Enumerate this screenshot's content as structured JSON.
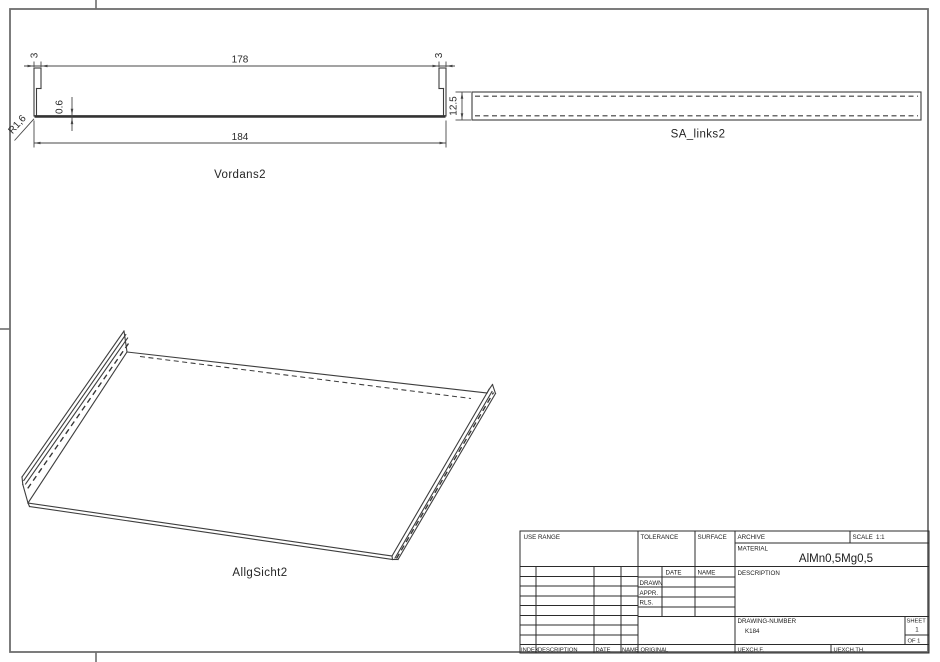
{
  "drawing": {
    "views": {
      "front": {
        "label": "Vordans2",
        "dim_flange_left": "3",
        "dim_inner_width": "178",
        "dim_flange_right": "3",
        "dim_overall_width": "184",
        "dim_thickness": "0.6",
        "dim_radius": "R1,6"
      },
      "side": {
        "label": "SA_links2",
        "dim_height": "12.5"
      },
      "iso": {
        "label": "AllgSicht2"
      }
    },
    "title_block": {
      "use_range": "USE RANGE",
      "tolerance": "TOLERANCE",
      "surface": "SURFACE",
      "archive": "ARCHIVE",
      "scale_label": "SCALE",
      "scale_value": "1:1",
      "material_label": "MATERIAL",
      "material_value": "AlMn0,5Mg0,5",
      "description_label": "DESCRIPTION",
      "date_label": "DATE",
      "name_label": "NAME",
      "drawn_label": "DRAWN",
      "appr_label": "APPR.",
      "rls_label": "RLS.",
      "drawing_number_label": "DRAWING-NUMBER",
      "drawing_number_value": "K184",
      "sheet_label": "SHEET",
      "sheet_value": "1",
      "of_value": "OF 1",
      "index_label": "INDEX",
      "description_col_label": "DESCRIPTION",
      "date_col_label": "DATE",
      "name_col_label": "NAME",
      "original_label": "ORIGINAL",
      "uexchf_label": "UEXCH.F.",
      "uexchth_label": "UEXCH.TH."
    },
    "colors": {
      "ink": "#3d3d3d",
      "frame": "#6e6e6e",
      "background": "#ffffff"
    }
  }
}
